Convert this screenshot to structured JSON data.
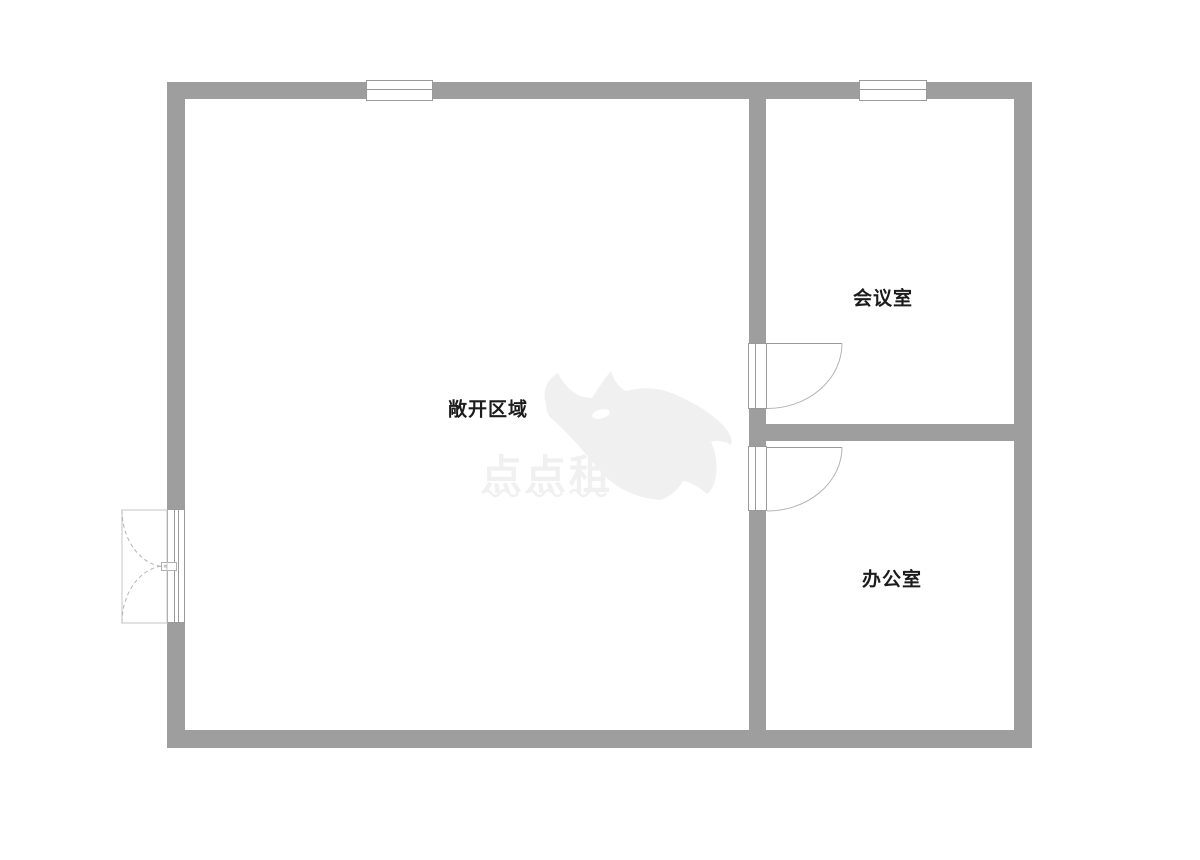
{
  "plan": {
    "type": "floor-plan",
    "rooms": [
      {
        "id": "open-area",
        "label": "敞开区域"
      },
      {
        "id": "meeting-room",
        "label": "会议室"
      },
      {
        "id": "office",
        "label": "办公室"
      }
    ],
    "watermark": {
      "brand_text": "点点租",
      "logo_icon": "rhino-logo",
      "color": "#f0f0f0"
    },
    "colors": {
      "wall": "#9e9e9e",
      "frame_line": "#9a9a9a",
      "door_arc": "#b3b3b3",
      "label_text": "#1c1c1c",
      "background": "#ffffff"
    }
  }
}
